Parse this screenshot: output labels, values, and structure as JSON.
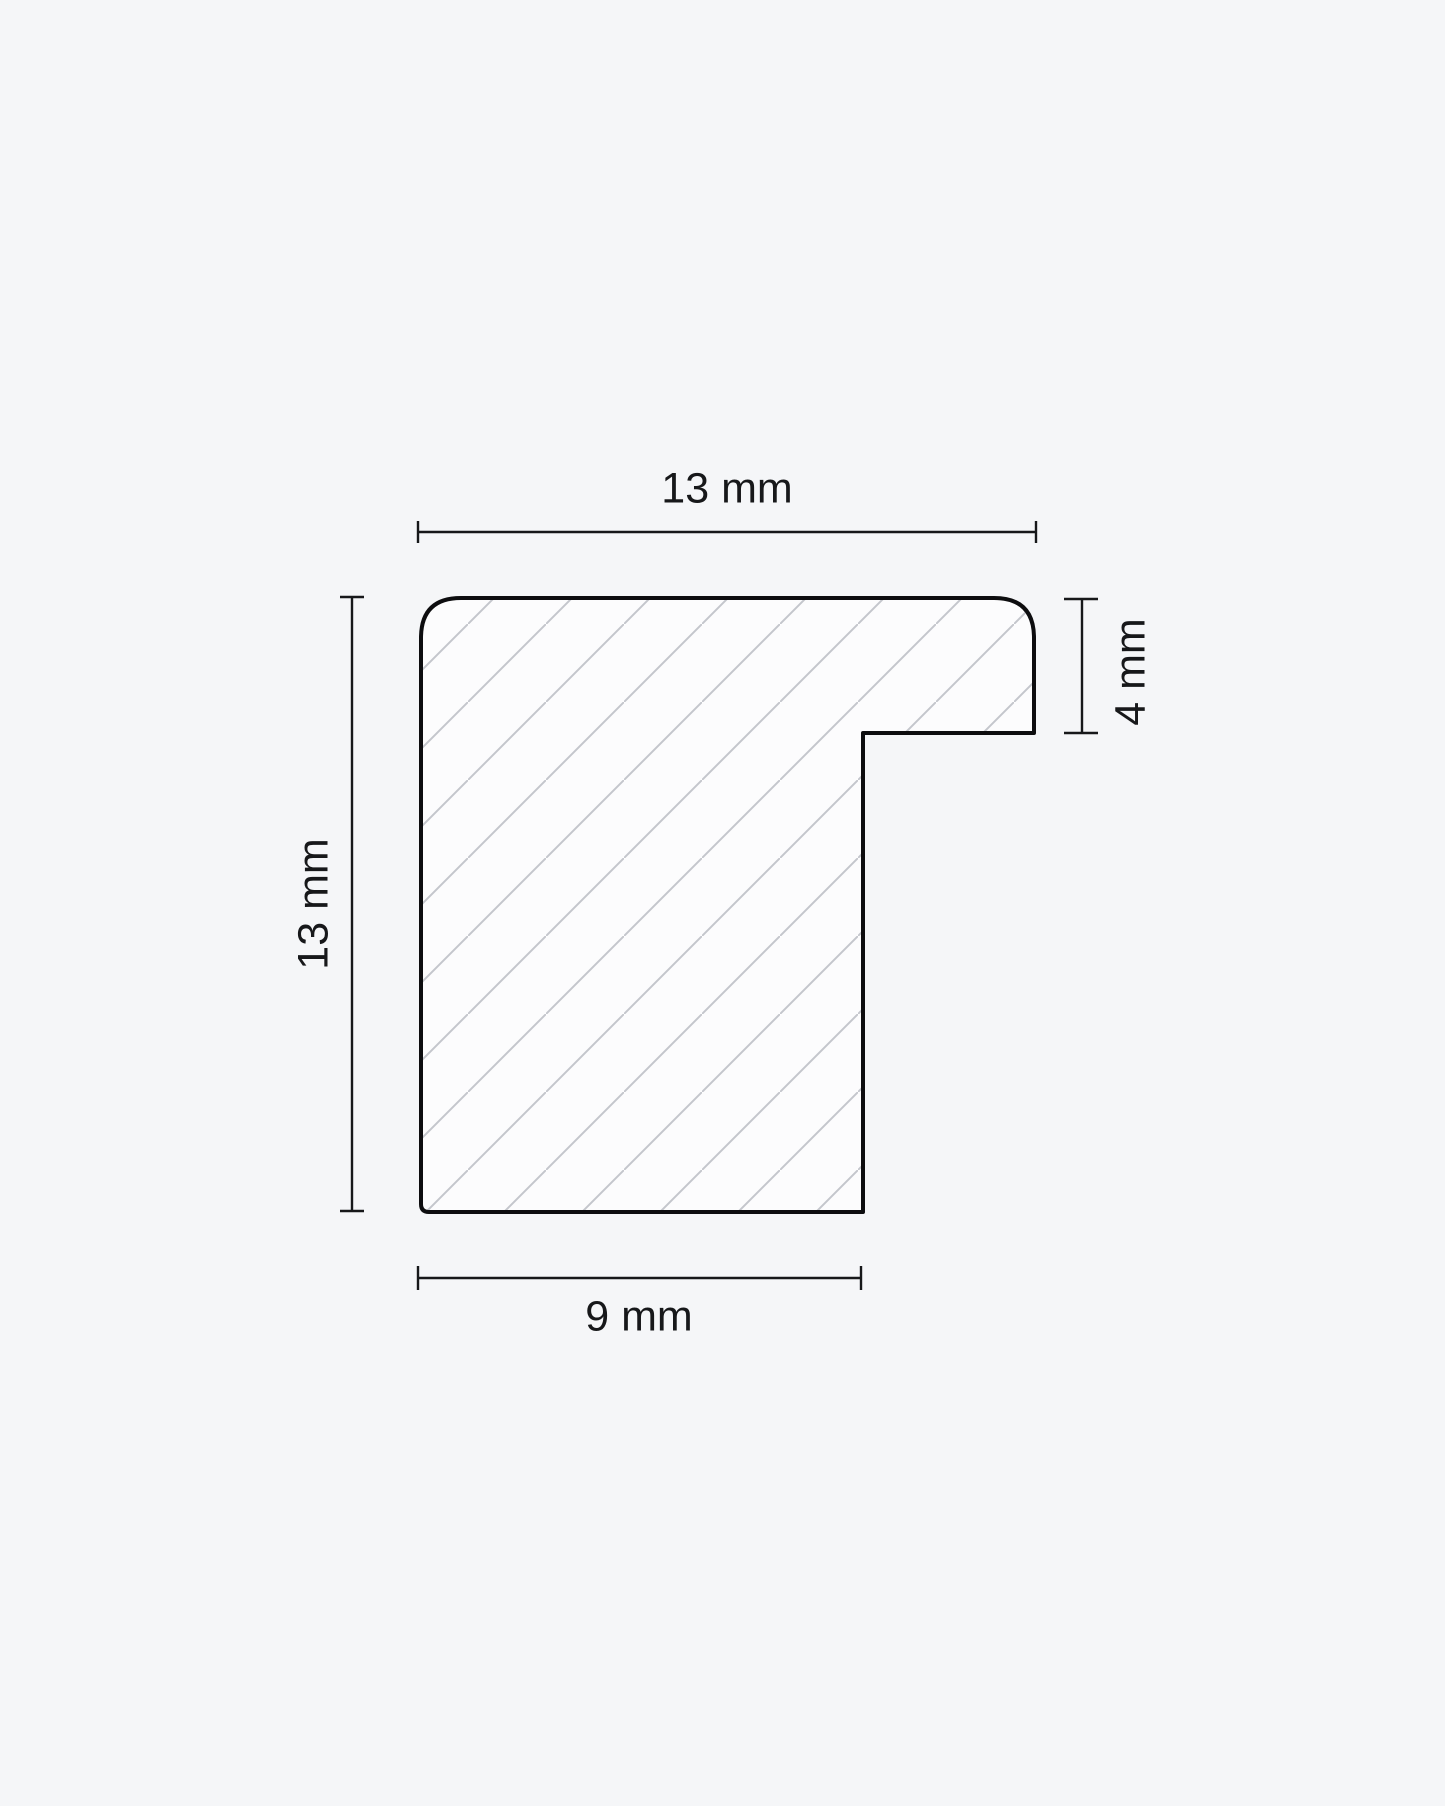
{
  "diagram": {
    "dimensions": {
      "top_width": "13 mm",
      "left_height": "13 mm",
      "lip_height": "4 mm",
      "bottom_width": "9 mm"
    },
    "colors": {
      "background": "#f5f6f8",
      "fill": "#fcfcfd",
      "hatch": "#c4c6cc",
      "outline": "#0d0d0f",
      "dimension": "#17181a",
      "text": "#17181a"
    }
  }
}
